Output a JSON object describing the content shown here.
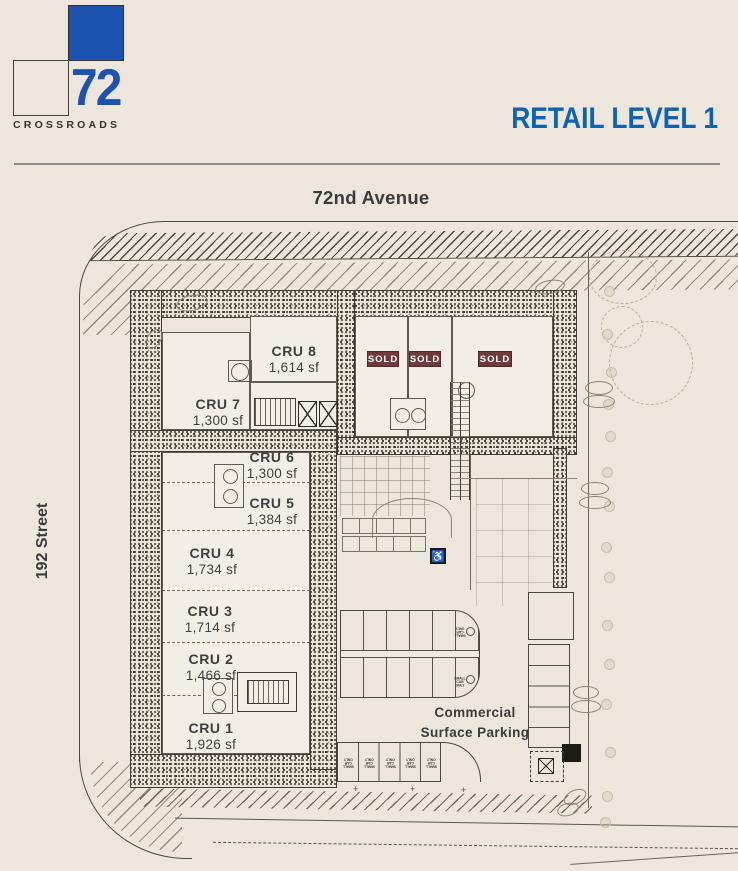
{
  "logo": {
    "number": "72",
    "name": "CROSSROADS"
  },
  "header": {
    "title": "RETAIL LEVEL 1"
  },
  "streets": {
    "top": "72nd Avenue",
    "left": "192 Street"
  },
  "plan": {
    "units": [
      {
        "id": "cru-8",
        "name": "CRU 8",
        "area": "1,614 sf"
      },
      {
        "id": "cru-7",
        "name": "CRU 7",
        "area": "1,300 sf"
      },
      {
        "id": "cru-6",
        "name": "CRU 6",
        "area": "1,300 sf"
      },
      {
        "id": "cru-5",
        "name": "CRU 5",
        "area": "1,384 sf"
      },
      {
        "id": "cru-4",
        "name": "CRU 4",
        "area": "1,734 sf"
      },
      {
        "id": "cru-3",
        "name": "CRU 3",
        "area": "1,714 sf"
      },
      {
        "id": "cru-2",
        "name": "CRU 2",
        "area": "1,466 sf"
      },
      {
        "id": "cru-1",
        "name": "CRU 1",
        "area": "1,926 sf"
      }
    ],
    "sold_badges": [
      "SOLD",
      "SOLD",
      "SOLD"
    ],
    "parking": {
      "line1": "Commercial",
      "line2": "Surface Parking"
    },
    "stall_label": "SMALL CAR ONLY",
    "colors": {
      "logo_blue": "#1c53b0",
      "title_blue": "#0c63b1",
      "sold_bg": "#6f3a3c"
    }
  }
}
